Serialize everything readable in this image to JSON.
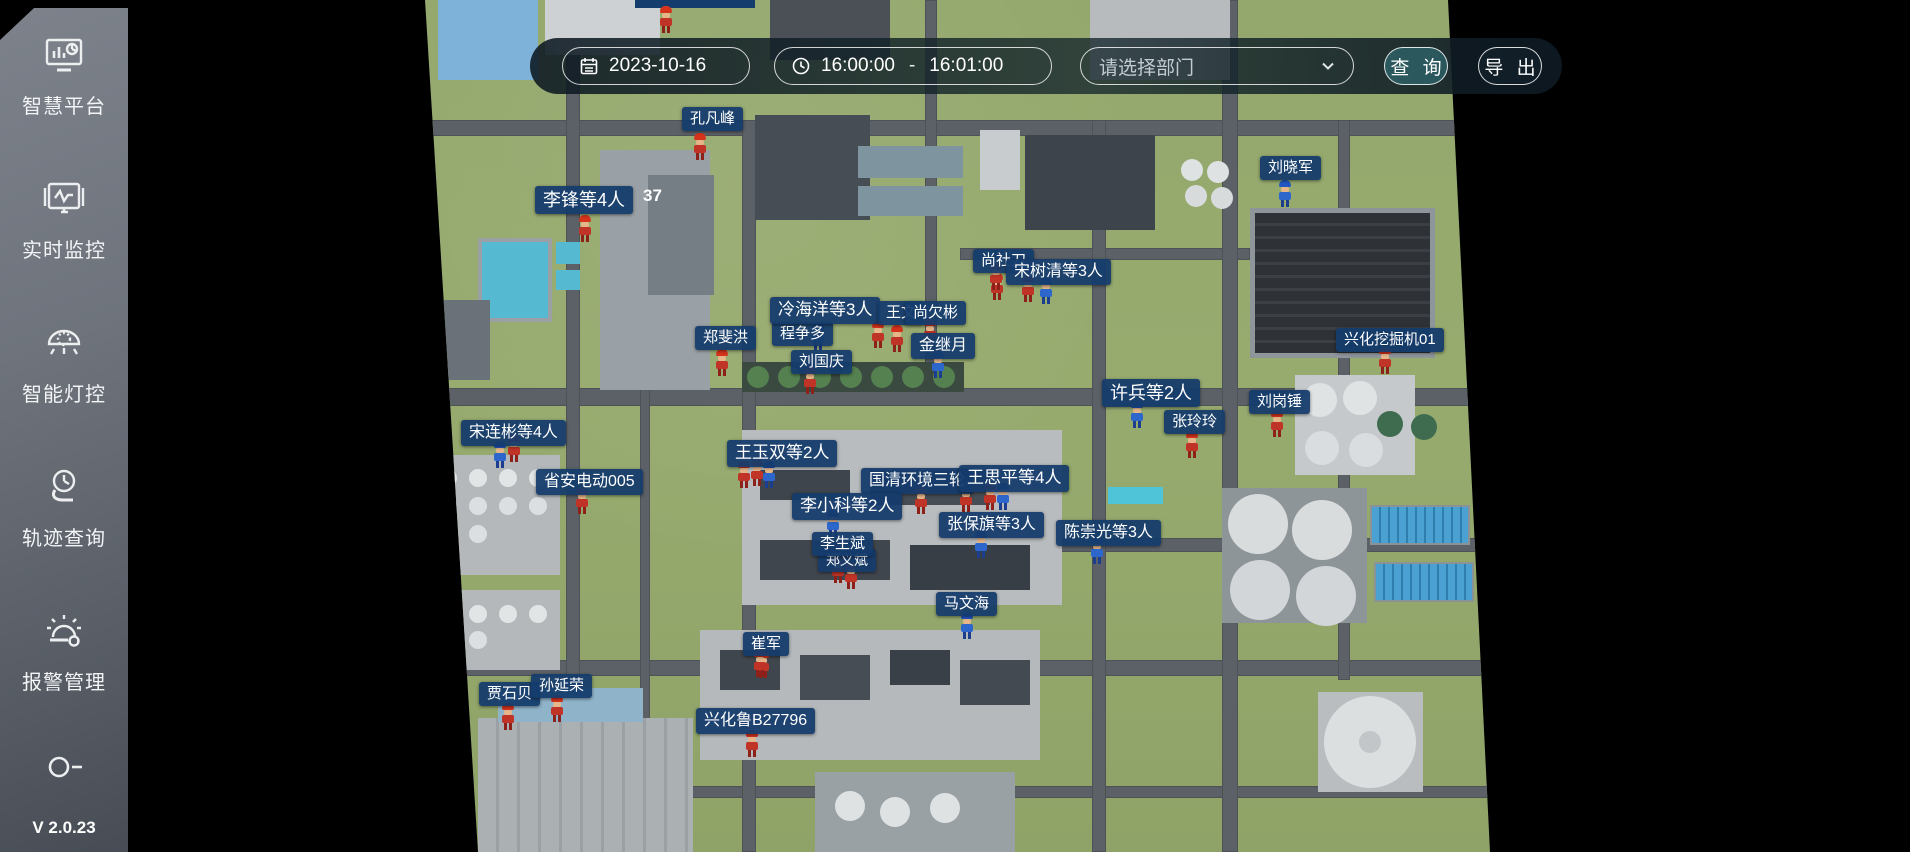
{
  "sidebar": {
    "items": [
      {
        "icon": "platform-icon",
        "label": "智慧平台"
      },
      {
        "icon": "monitor-icon",
        "label": "实时监控"
      },
      {
        "icon": "light-icon",
        "label": "智能灯控"
      },
      {
        "icon": "track-icon",
        "label": "轨迹查询"
      },
      {
        "icon": "alarm-icon",
        "label": "报警管理"
      },
      {
        "icon": "person-icon",
        "label": ""
      }
    ],
    "version": "V 2.0.23"
  },
  "toolbar": {
    "date": "2023-10-16",
    "time_start": "16:00:00",
    "time_separator": "-",
    "time_end": "16:01:00",
    "dept_placeholder": "请选择部门",
    "query_label": "查 询",
    "export_label": "导 出"
  },
  "map": {
    "colors": {
      "label_bg": "#143c6c",
      "grass": "#95a96e",
      "road": "#5c6167",
      "accent_red": "#d6331c",
      "accent_blue": "#2257c4"
    },
    "roads": [
      {
        "x": 425,
        "y": 120,
        "w": 1040,
        "h": 16
      },
      {
        "x": 425,
        "y": 388,
        "w": 1065,
        "h": 18
      },
      {
        "x": 1060,
        "y": 538,
        "w": 430,
        "h": 14
      },
      {
        "x": 425,
        "y": 660,
        "w": 1065,
        "h": 16
      },
      {
        "x": 690,
        "y": 786,
        "w": 800,
        "h": 12
      },
      {
        "x": 960,
        "y": 248,
        "w": 290,
        "h": 12
      },
      {
        "x": 566,
        "y": 0,
        "w": 14,
        "h": 852
      },
      {
        "x": 742,
        "y": 120,
        "w": 14,
        "h": 732
      },
      {
        "x": 925,
        "y": 0,
        "w": 12,
        "h": 390
      },
      {
        "x": 1092,
        "y": 120,
        "w": 14,
        "h": 732
      },
      {
        "x": 1222,
        "y": 0,
        "w": 16,
        "h": 852
      },
      {
        "x": 1338,
        "y": 120,
        "w": 12,
        "h": 560
      },
      {
        "x": 640,
        "y": 388,
        "w": 10,
        "h": 464
      }
    ],
    "blocks": [
      {
        "x": 438,
        "y": 0,
        "w": 100,
        "h": 80,
        "c": "#7fb2d8"
      },
      {
        "x": 545,
        "y": 0,
        "w": 115,
        "h": 55,
        "c": "#cdd1d3"
      },
      {
        "x": 770,
        "y": 0,
        "w": 120,
        "h": 60,
        "c": "#4a5056"
      },
      {
        "x": 1090,
        "y": 0,
        "w": 140,
        "h": 80,
        "c": "#b7bbbd"
      },
      {
        "x": 635,
        "y": 0,
        "w": 120,
        "h": 8,
        "c": "#143c6c"
      },
      {
        "x": 478,
        "y": 238,
        "w": 74,
        "h": 84,
        "c": "#55b9d2",
        "border": "4px solid #9aa0a3"
      },
      {
        "x": 556,
        "y": 242,
        "w": 24,
        "h": 22,
        "c": "#55b9d2"
      },
      {
        "x": 556,
        "y": 270,
        "w": 24,
        "h": 20,
        "c": "#55b9d2"
      },
      {
        "x": 600,
        "y": 150,
        "w": 110,
        "h": 240,
        "c": "#9aa1a6"
      },
      {
        "x": 648,
        "y": 175,
        "w": 66,
        "h": 120,
        "c": "#767e85"
      },
      {
        "x": 755,
        "y": 115,
        "w": 115,
        "h": 105,
        "c": "#474d54"
      },
      {
        "x": 858,
        "y": 146,
        "w": 105,
        "h": 32,
        "c": "#7e949e"
      },
      {
        "x": 858,
        "y": 186,
        "w": 105,
        "h": 30,
        "c": "#7e949e"
      },
      {
        "x": 1025,
        "y": 135,
        "w": 130,
        "h": 95,
        "c": "#3e444b"
      },
      {
        "x": 980,
        "y": 130,
        "w": 40,
        "h": 60,
        "c": "#c8ccce"
      },
      {
        "x": 1250,
        "y": 208,
        "w": 185,
        "h": 150,
        "c": "#34383d",
        "cls": "panels"
      },
      {
        "x": 430,
        "y": 300,
        "w": 60,
        "h": 80,
        "c": "#6a7178"
      },
      {
        "x": 742,
        "y": 362,
        "w": 222,
        "h": 30,
        "c": "#3a4a40"
      },
      {
        "x": 742,
        "y": 430,
        "w": 320,
        "h": 175,
        "c": "#b8bcbe"
      },
      {
        "x": 760,
        "y": 470,
        "w": 90,
        "h": 30,
        "c": "#3f454c"
      },
      {
        "x": 870,
        "y": 470,
        "w": 120,
        "h": 35,
        "c": "#474d54"
      },
      {
        "x": 760,
        "y": 540,
        "w": 130,
        "h": 40,
        "c": "#40464d"
      },
      {
        "x": 910,
        "y": 545,
        "w": 120,
        "h": 45,
        "c": "#383e45"
      },
      {
        "x": 1108,
        "y": 487,
        "w": 55,
        "h": 17,
        "c": "#4fc3d8"
      },
      {
        "x": 1295,
        "y": 375,
        "w": 120,
        "h": 100,
        "c": "#c5c9cb"
      },
      {
        "x": 1222,
        "y": 488,
        "w": 145,
        "h": 135,
        "c": "#8e9599"
      },
      {
        "x": 1370,
        "y": 505,
        "w": 100,
        "h": 40,
        "c": "#4ba2d2",
        "cls": "stripes-v"
      },
      {
        "x": 1374,
        "y": 562,
        "w": 100,
        "h": 40,
        "c": "#4ba2d2",
        "cls": "stripes-v"
      },
      {
        "x": 1318,
        "y": 692,
        "w": 105,
        "h": 100,
        "c": "#b9bdbf"
      },
      {
        "x": 478,
        "y": 718,
        "w": 215,
        "h": 134,
        "c": "#a9aeb1",
        "cls": "ridged"
      },
      {
        "x": 498,
        "y": 688,
        "w": 145,
        "h": 34,
        "c": "#8fb3c9"
      },
      {
        "x": 700,
        "y": 630,
        "w": 340,
        "h": 130,
        "c": "#b5b9bb"
      },
      {
        "x": 720,
        "y": 650,
        "w": 60,
        "h": 40,
        "c": "#40464d"
      },
      {
        "x": 800,
        "y": 655,
        "w": 70,
        "h": 45,
        "c": "#474d54"
      },
      {
        "x": 890,
        "y": 650,
        "w": 60,
        "h": 35,
        "c": "#3a4047"
      },
      {
        "x": 960,
        "y": 660,
        "w": 70,
        "h": 45,
        "c": "#444a51"
      },
      {
        "x": 815,
        "y": 772,
        "w": 200,
        "h": 80,
        "c": "#9aa1a5"
      },
      {
        "x": 430,
        "y": 455,
        "w": 130,
        "h": 120,
        "c": "#b4b8ba"
      },
      {
        "x": 430,
        "y": 590,
        "w": 130,
        "h": 80,
        "c": "#b4b8ba"
      }
    ],
    "circles": [
      {
        "cx": 1192,
        "cy": 170,
        "r": 11,
        "c": "#dfe2e3"
      },
      {
        "cx": 1218,
        "cy": 172,
        "r": 11,
        "c": "#dfe2e3"
      },
      {
        "cx": 1196,
        "cy": 196,
        "r": 11,
        "c": "#d8dbdc"
      },
      {
        "cx": 1222,
        "cy": 198,
        "r": 11,
        "c": "#d8dbdc"
      },
      {
        "cx": 758,
        "cy": 377,
        "r": 11,
        "c": "#55804f"
      },
      {
        "cx": 789,
        "cy": 377,
        "r": 11,
        "c": "#55804f"
      },
      {
        "cx": 820,
        "cy": 377,
        "r": 11,
        "c": "#55804f"
      },
      {
        "cx": 851,
        "cy": 377,
        "r": 11,
        "c": "#55804f"
      },
      {
        "cx": 882,
        "cy": 377,
        "r": 11,
        "c": "#55804f"
      },
      {
        "cx": 913,
        "cy": 377,
        "r": 11,
        "c": "#55804f"
      },
      {
        "cx": 944,
        "cy": 377,
        "r": 11,
        "c": "#55804f"
      },
      {
        "cx": 1320,
        "cy": 400,
        "r": 17,
        "c": "#e0e3e4"
      },
      {
        "cx": 1360,
        "cy": 398,
        "r": 17,
        "c": "#e0e3e4"
      },
      {
        "cx": 1322,
        "cy": 448,
        "r": 17,
        "c": "#dadde0"
      },
      {
        "cx": 1366,
        "cy": 450,
        "r": 17,
        "c": "#dadde0"
      },
      {
        "cx": 1390,
        "cy": 424,
        "r": 13,
        "c": "#3f6b4e"
      },
      {
        "cx": 1424,
        "cy": 427,
        "r": 13,
        "c": "#3f6b4e"
      },
      {
        "cx": 1258,
        "cy": 524,
        "r": 30,
        "c": "#d9dcdd"
      },
      {
        "cx": 1322,
        "cy": 530,
        "r": 30,
        "c": "#d9dcdd"
      },
      {
        "cx": 1260,
        "cy": 590,
        "r": 30,
        "c": "#d3d6d8"
      },
      {
        "cx": 1326,
        "cy": 596,
        "r": 30,
        "c": "#d3d6d8"
      },
      {
        "cx": 1370,
        "cy": 742,
        "r": 46,
        "c": "#dcdfe0"
      },
      {
        "cx": 1370,
        "cy": 742,
        "r": 11,
        "c": "#c2c6c9"
      },
      {
        "cx": 850,
        "cy": 806,
        "r": 15,
        "c": "#dfe2e3"
      },
      {
        "cx": 895,
        "cy": 812,
        "r": 15,
        "c": "#dfe2e3"
      },
      {
        "cx": 945,
        "cy": 808,
        "r": 15,
        "c": "#dfe2e3"
      },
      {
        "cx": 448,
        "cy": 478,
        "r": 9,
        "c": "#e2e5e6"
      },
      {
        "cx": 478,
        "cy": 478,
        "r": 9,
        "c": "#e2e5e6"
      },
      {
        "cx": 508,
        "cy": 478,
        "r": 9,
        "c": "#e2e5e6"
      },
      {
        "cx": 538,
        "cy": 478,
        "r": 9,
        "c": "#e2e5e6"
      },
      {
        "cx": 448,
        "cy": 506,
        "r": 9,
        "c": "#dcdfe1"
      },
      {
        "cx": 478,
        "cy": 506,
        "r": 9,
        "c": "#dcdfe1"
      },
      {
        "cx": 508,
        "cy": 506,
        "r": 9,
        "c": "#dcdfe1"
      },
      {
        "cx": 538,
        "cy": 506,
        "r": 9,
        "c": "#dcdfe1"
      },
      {
        "cx": 448,
        "cy": 534,
        "r": 9,
        "c": "#dcdfe1"
      },
      {
        "cx": 478,
        "cy": 534,
        "r": 9,
        "c": "#dcdfe1"
      },
      {
        "cx": 448,
        "cy": 614,
        "r": 9,
        "c": "#e2e5e6"
      },
      {
        "cx": 478,
        "cy": 614,
        "r": 9,
        "c": "#e2e5e6"
      },
      {
        "cx": 508,
        "cy": 614,
        "r": 9,
        "c": "#e2e5e6"
      },
      {
        "cx": 538,
        "cy": 614,
        "r": 9,
        "c": "#e2e5e6"
      },
      {
        "cx": 448,
        "cy": 640,
        "r": 9,
        "c": "#dcdfe1"
      },
      {
        "cx": 478,
        "cy": 640,
        "r": 9,
        "c": "#dcdfe1"
      }
    ],
    "labels": [
      {
        "text": "程争多",
        "x": 772,
        "y": 322,
        "s": 15
      },
      {
        "text": "冷海洋等3人",
        "x": 770,
        "y": 297,
        "s": 17
      },
      {
        "text": "王文",
        "x": 878,
        "y": 301,
        "s": 15
      },
      {
        "text": "尚欠彬",
        "x": 905,
        "y": 301,
        "s": 15
      },
      {
        "text": "金继月",
        "x": 911,
        "y": 333,
        "s": 16
      },
      {
        "text": "刘国庆",
        "x": 791,
        "y": 350,
        "s": 15
      },
      {
        "text": "郑斐洪",
        "x": 695,
        "y": 326,
        "s": 15
      },
      {
        "text": "尚社刀",
        "x": 973,
        "y": 249,
        "s": 15
      },
      {
        "text": "宋树清等3人",
        "x": 1006,
        "y": 259,
        "s": 16
      },
      {
        "text": "孔凡峰",
        "x": 682,
        "y": 107,
        "s": 15
      },
      {
        "text": "李锋等4人",
        "x": 535,
        "y": 186,
        "s": 18
      },
      {
        "text": "刘晓军",
        "x": 1260,
        "y": 156,
        "s": 15
      },
      {
        "text": "兴化挖掘机01",
        "x": 1336,
        "y": 328,
        "s": 15
      },
      {
        "text": "许兵等2人",
        "x": 1102,
        "y": 379,
        "s": 18
      },
      {
        "text": "刘岗锤",
        "x": 1249,
        "y": 390,
        "s": 15
      },
      {
        "text": "张玲玲",
        "x": 1164,
        "y": 410,
        "s": 15
      },
      {
        "text": "宋连彬等4人",
        "x": 461,
        "y": 420,
        "s": 16
      },
      {
        "text": "省安电动005",
        "x": 536,
        "y": 469,
        "s": 16
      },
      {
        "text": "王玉双等2人",
        "x": 727,
        "y": 440,
        "s": 17
      },
      {
        "text": "国清环境三轮",
        "x": 861,
        "y": 468,
        "s": 16
      },
      {
        "text": "王思平等4人",
        "x": 959,
        "y": 465,
        "s": 17
      },
      {
        "text": "李小科等2人",
        "x": 792,
        "y": 493,
        "s": 17
      },
      {
        "text": "张保旗等3人",
        "x": 939,
        "y": 512,
        "s": 16
      },
      {
        "text": "郑义斌",
        "x": 818,
        "y": 549,
        "s": 14
      },
      {
        "text": "李生斌",
        "x": 812,
        "y": 532,
        "s": 15
      },
      {
        "text": "陈崇光等3人",
        "x": 1056,
        "y": 520,
        "s": 16
      },
      {
        "text": "马文海",
        "x": 936,
        "y": 592,
        "s": 15
      },
      {
        "text": "崔军",
        "x": 743,
        "y": 632,
        "s": 15
      },
      {
        "text": "贾石贝",
        "x": 479,
        "y": 682,
        "s": 15
      },
      {
        "text": "孙延荣",
        "x": 531,
        "y": 674,
        "s": 15
      },
      {
        "text": "兴化鲁B27796",
        "x": 696,
        "y": 708,
        "s": 16
      }
    ],
    "texts": [
      {
        "text": "37",
        "x": 643,
        "y": 186,
        "s": 17
      }
    ],
    "workers": [
      {
        "x": 666,
        "y": 33,
        "c": "red"
      },
      {
        "x": 700,
        "y": 160,
        "c": "red"
      },
      {
        "x": 585,
        "y": 242,
        "c": "red"
      },
      {
        "x": 1285,
        "y": 207,
        "c": "blue"
      },
      {
        "x": 997,
        "y": 300,
        "c": "red"
      },
      {
        "x": 1028,
        "y": 302,
        "c": "red"
      },
      {
        "x": 1046,
        "y": 304,
        "c": "blue"
      },
      {
        "x": 818,
        "y": 350,
        "c": "blue"
      },
      {
        "x": 878,
        "y": 348,
        "c": "red"
      },
      {
        "x": 897,
        "y": 352,
        "c": "red"
      },
      {
        "x": 930,
        "y": 346,
        "c": "red"
      },
      {
        "x": 938,
        "y": 378,
        "c": "blue"
      },
      {
        "x": 996,
        "y": 290,
        "c": "red"
      },
      {
        "x": 722,
        "y": 376,
        "c": "red"
      },
      {
        "x": 810,
        "y": 394,
        "c": "red"
      },
      {
        "x": 1385,
        "y": 374,
        "c": "red"
      },
      {
        "x": 1137,
        "y": 428,
        "c": "blue"
      },
      {
        "x": 1277,
        "y": 437,
        "c": "red"
      },
      {
        "x": 1192,
        "y": 458,
        "c": "red"
      },
      {
        "x": 500,
        "y": 468,
        "c": "blue"
      },
      {
        "x": 514,
        "y": 462,
        "c": "red"
      },
      {
        "x": 582,
        "y": 514,
        "c": "red"
      },
      {
        "x": 744,
        "y": 488,
        "c": "red"
      },
      {
        "x": 757,
        "y": 486,
        "c": "red"
      },
      {
        "x": 769,
        "y": 488,
        "c": "blue"
      },
      {
        "x": 921,
        "y": 514,
        "c": "red"
      },
      {
        "x": 966,
        "y": 512,
        "c": "red"
      },
      {
        "x": 990,
        "y": 510,
        "c": "red"
      },
      {
        "x": 1003,
        "y": 510,
        "c": "blue"
      },
      {
        "x": 833,
        "y": 537,
        "c": "blue"
      },
      {
        "x": 981,
        "y": 558,
        "c": "blue"
      },
      {
        "x": 1097,
        "y": 564,
        "c": "blue"
      },
      {
        "x": 838,
        "y": 583,
        "c": "red"
      },
      {
        "x": 851,
        "y": 589,
        "c": "red"
      },
      {
        "x": 967,
        "y": 639,
        "c": "blue"
      },
      {
        "x": 763,
        "y": 678,
        "c": "red"
      },
      {
        "x": 508,
        "y": 730,
        "c": "red"
      },
      {
        "x": 557,
        "y": 722,
        "c": "red"
      },
      {
        "x": 752,
        "y": 757,
        "c": "red"
      },
      {
        "x": 760,
        "y": 677,
        "c": "red"
      }
    ]
  }
}
